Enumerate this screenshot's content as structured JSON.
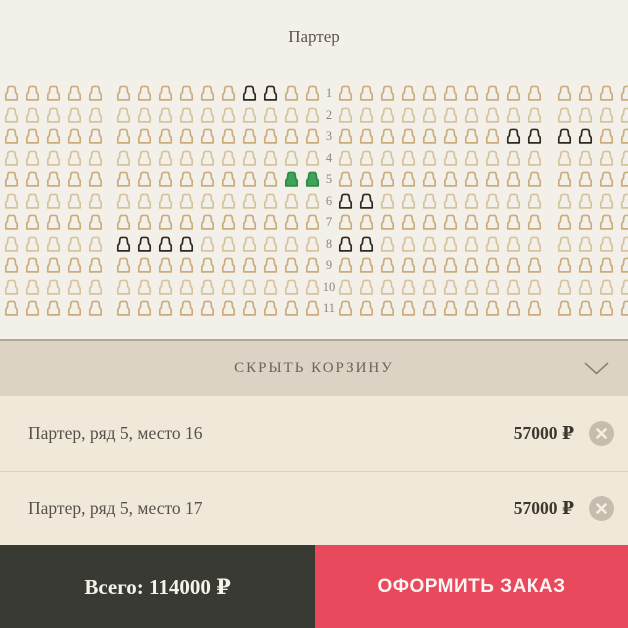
{
  "map": {
    "title": "Партер"
  },
  "seat_map": {
    "legend_note": "a=available, d=unavailable, s=selected",
    "colors": {
      "available": "#cbac7c",
      "available_alt": "#d6c39e",
      "unavailable": "#2e2a1d",
      "selected": "#3fa35a",
      "selected_border": "#2f8a48"
    },
    "rows": [
      {
        "num": "1",
        "left": "aaaaa",
        "center": "aaaaaaddaa",
        "right": "aaaaaaaaaa",
        "far": "aaaa"
      },
      {
        "num": "2",
        "left": "aaaaa",
        "center": "aaaaaaaaaa",
        "right": "aaaaaaaaaa",
        "far": "aaaa"
      },
      {
        "num": "3",
        "left": "aaaaa",
        "center": "aaaaaaaaaa",
        "right": "aaaaaaaadd",
        "far": "ddaa"
      },
      {
        "num": "4",
        "left": "aaaaa",
        "center": "aaaaaaaaaa",
        "right": "aaaaaaaaaa",
        "far": "aaaa"
      },
      {
        "num": "5",
        "left": "aaaaa",
        "center": "aaaaaaaass",
        "right": "aaaaaaaaaa",
        "far": "aaaa"
      },
      {
        "num": "6",
        "left": "aaaaa",
        "center": "aaaaaaaaaa",
        "right": "ddaaaaaaaa",
        "far": "aaaa"
      },
      {
        "num": "7",
        "left": "aaaaa",
        "center": "aaaaaaaaaa",
        "right": "aaaaaaaaaa",
        "far": "aaaa"
      },
      {
        "num": "8",
        "left": "aaaaa",
        "center": "ddddaaaaaa",
        "right": "ddaaaaaaaa",
        "far": "aaaa"
      },
      {
        "num": "9",
        "left": "aaaaa",
        "center": "aaaaaaaaaa",
        "right": "aaaaaaaaaa",
        "far": "aaaa"
      },
      {
        "num": "10",
        "left": "aaaaa",
        "center": "aaaaaaaaaa",
        "right": "aaaaaaaaaa",
        "far": "aaaa"
      },
      {
        "num": "11",
        "left": "aaaaa",
        "center": "aaaaaaaaaa",
        "right": "aaaaaaaaaa",
        "far": "aaaa"
      }
    ]
  },
  "cart": {
    "toggle_label": "СКРЫТЬ КОРЗИНУ",
    "chevron_icon": "chevron-down",
    "items": [
      {
        "label": "Партер, ряд 5, место 16",
        "price": "57000 ₽",
        "remove_icon": "close-x"
      },
      {
        "label": "Партер, ряд 5, место 17",
        "price": "57000 ₽",
        "remove_icon": "close-x"
      }
    ],
    "total_label": "Всего: 114000 ₽",
    "checkout_label": "ОФОРМИТЬ ЗАКАЗ"
  },
  "colors": {
    "background": "#f2efe8",
    "cart_header_bg": "#dcd3c4",
    "cart_bg": "#f0e9da",
    "bottom_dark": "#3a3a34",
    "accent_red": "#e8495c"
  }
}
